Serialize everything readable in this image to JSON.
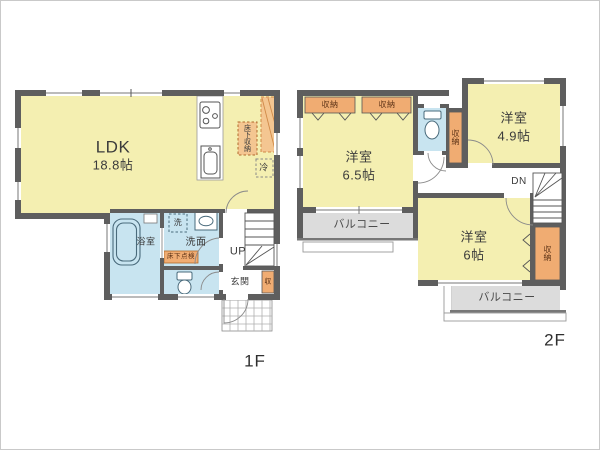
{
  "colors": {
    "room_yellow": "#F4EFB1",
    "wet_area_blue": "#C8E4F0",
    "storage_orange": "#F0AC72",
    "pantry_orange": "#F4C691",
    "balcony_gray": "#DCDCDC",
    "wall_gray": "#5E5E5E"
  },
  "floor1": {
    "floor_label": "1F",
    "ldk": {
      "name": "LDK",
      "size": "18.8帖"
    },
    "kitchen": {
      "underfloor_storage": "床下収納",
      "refrigerator": "冷"
    },
    "bathroom": {
      "name": "浴室"
    },
    "washroom": {
      "name": "洗面",
      "washing_machine": "洗",
      "underfloor_access": "床下点検"
    },
    "entrance": {
      "name": "玄関",
      "storage": "収"
    },
    "stairs": {
      "label": "UP"
    }
  },
  "floor2": {
    "floor_label": "2F",
    "room_65": {
      "name": "洋室",
      "size": "6.5帖",
      "closet_left": "収納",
      "closet_right": "収納"
    },
    "room_49": {
      "name": "洋室",
      "size": "4.9帖"
    },
    "room_6": {
      "name": "洋室",
      "size": "6帖",
      "closet": "収納"
    },
    "hall_storage": {
      "label": "収納"
    },
    "stairs": {
      "label": "DN"
    },
    "balcony_left": {
      "label": "バルコニー"
    },
    "balcony_bottom": {
      "label": "バルコニー"
    }
  }
}
